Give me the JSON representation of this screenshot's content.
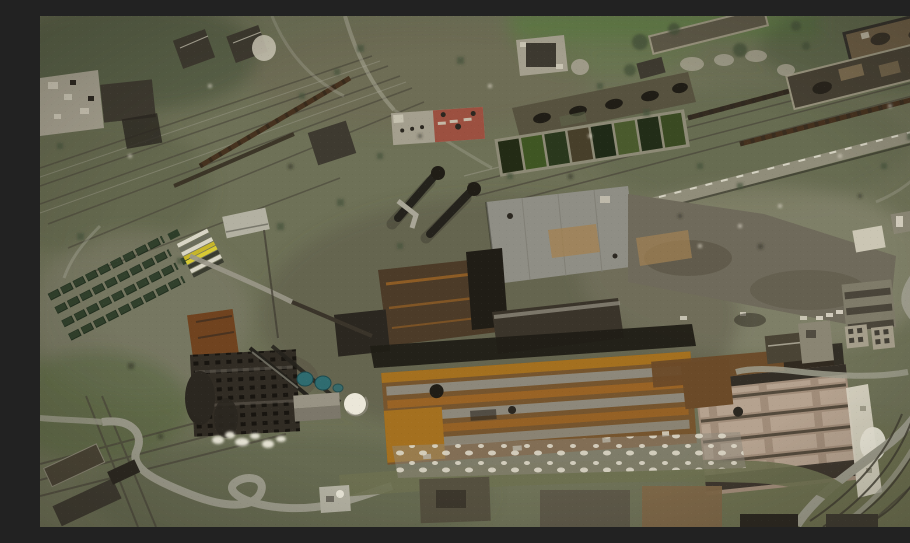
{
  "meta": {
    "alt": "Satellite view of a heavily damaged industrial steelworks complex with rail yards, freight trains, storage rows, settling ponds, gantry cranes and rust-stained factory roofs"
  },
  "palette": {
    "base": "#6e7157",
    "oliveDark": "#5e644a",
    "grayGreen": "#7d7c69",
    "paleField": "#8d8a75",
    "brownField": "#6e6753",
    "darkGreen": "#47523a",
    "greenLow": "#5c6a44",
    "grassBright": "#5f7c44",
    "roadLight": "#9d9c8c",
    "roadPale": "#b3b1a2",
    "railDark": "#4b473b",
    "trainBrown": "#46321f",
    "trainDark": "#342b20",
    "ruinPale": "#a49f8e",
    "ruinWhite": "#c9c4b3",
    "roofDark": "#3e3a30",
    "charcoal": "#2b2720",
    "blackShed": "#201d16",
    "ironDark": "#3a342a",
    "redRoof": "#9c5040",
    "hallRoof": "#57523f",
    "pondBorder": "#8d8a76",
    "pond1": "#232b15",
    "pond2": "#3f5623",
    "pond3": "#2a381d",
    "pond4": "#473f2a",
    "pond5": "#1f2a17",
    "pond6": "#4a5a2d",
    "pond7": "#222d18",
    "pond8": "#3a4a22",
    "grayRoof": "#8f8e85",
    "graySeam": "#7d7c72",
    "tanPatch": "#a38253",
    "yardGray": "#6f6a5b",
    "yardShadow": "#5b5646",
    "rustDark": "#4c3b28",
    "rustOrange": "#996325",
    "rustBright": "#a4701f",
    "rustBase": "#76552e",
    "rustBand": "#6b4a28",
    "stripeGray": "#8d887b",
    "ribBase": "#a08c79",
    "ribPanel": "#b5a28f",
    "ribGap": "#544a3c",
    "ribDarkBand": "#332e26",
    "whiteDebris": "#dbd6c6",
    "smoke": "#eae7d9",
    "teal": "#2f6c70",
    "tealEdge": "#1d4a4e",
    "dome": "#ebe7d9",
    "domeEdge": "#9a9588",
    "brownBld": "#70431f",
    "cokeDark": "#312c24",
    "cokeDot": "#15120e",
    "shedGreen": "#2d3d29",
    "shedEdge": "#1d2b1b",
    "yellow1": "#d8ca33",
    "yellow2": "#c7b62a",
    "stripeLight": "#d8d5c5",
    "stripeDark": "#3a3c30",
    "stripeMid": "#6a6c5c",
    "conveyor": "#9a9788",
    "craneDark": "#24221c",
    "pipeLight": "#a9a697",
    "paleStrip": "#908d7a",
    "oliveBand": "#6d7050",
    "arcDark": "#3f3b30",
    "smallWhite": "#cbc6b4",
    "smallGray": "#8b8775",
    "courtyard": "#a59e8b",
    "bldDark": "#4a4435",
    "bldGray": "#8a8573",
    "blockGray": "#7f7b69",
    "blockStrip": "#4a453a",
    "warehouseDark": "#474134",
    "warehouseEdge": "#9a957f",
    "tanPatch2": "#7c6c50",
    "bldBrownDark": "#6b5c44",
    "bldOutline": "#33302a",
    "thinBld": "#5d5847",
    "thinEdge": "#99947e",
    "pitchedRoof": "#989384",
    "pitchedShade": "#7c776a",
    "bottomBld1": "#55503f",
    "bottomBld2": "#5d5848",
    "bottomTan": "#7d6647"
  }
}
